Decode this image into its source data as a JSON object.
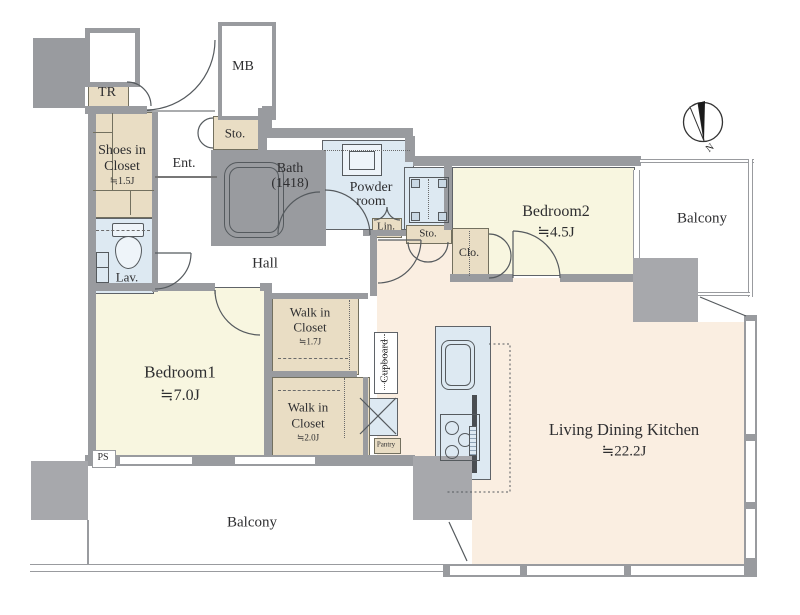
{
  "floorplan": {
    "compass": {
      "label": "N"
    },
    "rooms": {
      "bedroom1": {
        "name": "Bedroom1",
        "size": "≒7.0J"
      },
      "bedroom2": {
        "name": "Bedroom2",
        "size": "≒4.5J"
      },
      "ldk": {
        "name": "Living Dining Kitchen",
        "size": "≒22.2J"
      },
      "hall": {
        "name": "Hall"
      },
      "ent": {
        "name": "Ent."
      },
      "bath": {
        "name": "Bath",
        "size": "(1418)"
      },
      "powder_room": {
        "line1": "Powder",
        "line2": "room"
      },
      "lav": {
        "name": "Lav."
      },
      "shoes_in_closet": {
        "line1": "Shoes in",
        "line2": "Closet",
        "size": "≒1.5J"
      },
      "walk_in_closet_1": {
        "line1": "Walk in",
        "line2": "Closet",
        "size": "≒1.7J"
      },
      "walk_in_closet_2": {
        "line1": "Walk in",
        "line2": "Closet",
        "size": "≒2.0J"
      },
      "balcony_main": {
        "name": "Balcony"
      },
      "balcony_side": {
        "name": "Balcony"
      },
      "tr": {
        "name": "TR"
      },
      "mb": {
        "name": "MB"
      },
      "storage_entrance": {
        "name": "Sto."
      },
      "storage_hall": {
        "name": "Sto."
      },
      "linen": {
        "name": "Lin."
      },
      "closet": {
        "name": "Clo."
      },
      "cupboard": {
        "name": "Cupboard"
      },
      "pantry": {
        "name": "Pantry"
      },
      "ps": {
        "name": "PS"
      }
    },
    "colors": {
      "wall": "#999b9f",
      "room_yellow": "#f8f6e0",
      "room_peach": "#faeee1",
      "wet_area_blue": "#dde9f2",
      "closet_beige": "#e9ddc4",
      "line": "#5f6368"
    }
  }
}
